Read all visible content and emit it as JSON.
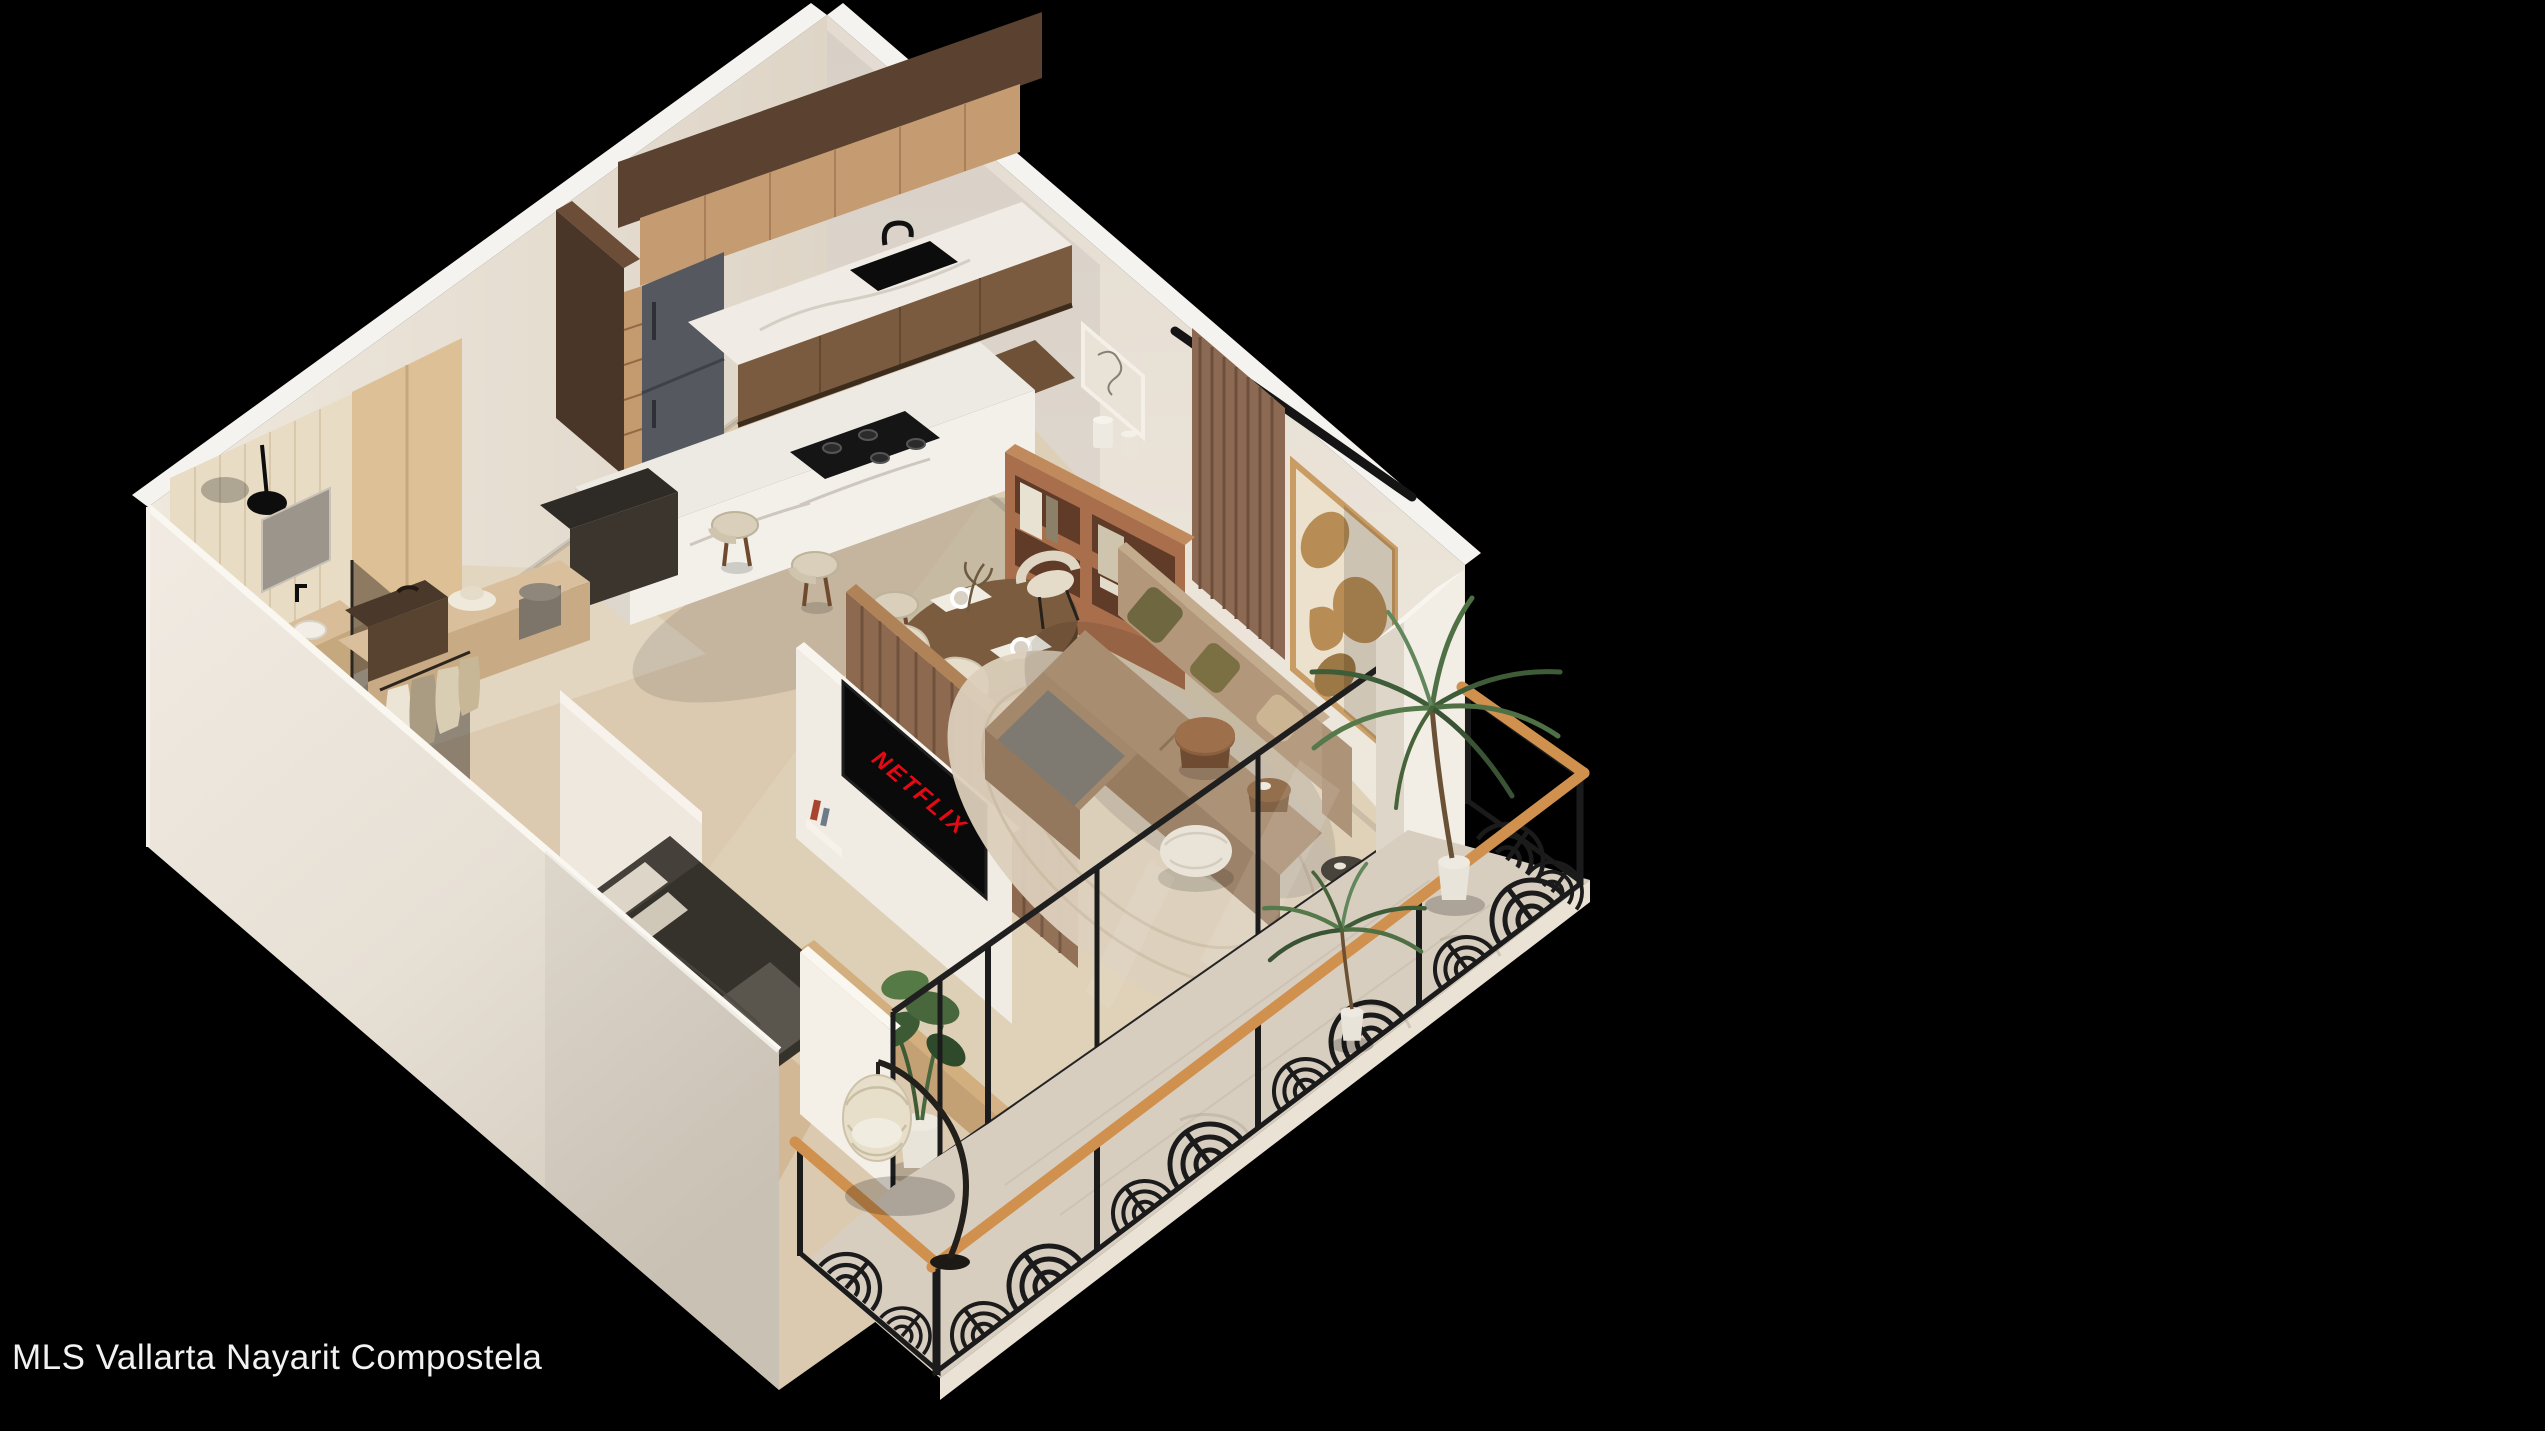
{
  "caption": {
    "text": "MLS Vallarta Nayarit Compostela"
  },
  "tv": {
    "label": "NETFLIX"
  },
  "colors": {
    "background": "#000000",
    "caption_text": "#f2f2f2",
    "netflix_red": "#e50914",
    "wall_cream": "#efe9e1",
    "wall_shadow": "#d6cec1",
    "floor_wood": "#d7bf9e",
    "kitchen_dark_wood": "#5a4130",
    "cabinet_tan": "#c59c72",
    "marble": "#f0ece5",
    "fridge_gray": "#565860",
    "sofa_beige": "#b2977a",
    "olive_pillow": "#6f673f",
    "railing_black": "#1b1b1b",
    "railing_wood_cap": "#d0904e",
    "plant_green": "#49673c",
    "art_tan": "#b78d55"
  },
  "render": {
    "type": "isometric-apartment-3d-floor-plan",
    "rooms": [
      "kitchen",
      "dining",
      "living-room",
      "bedroom",
      "walk-in-closet",
      "bathroom",
      "balcony"
    ]
  }
}
